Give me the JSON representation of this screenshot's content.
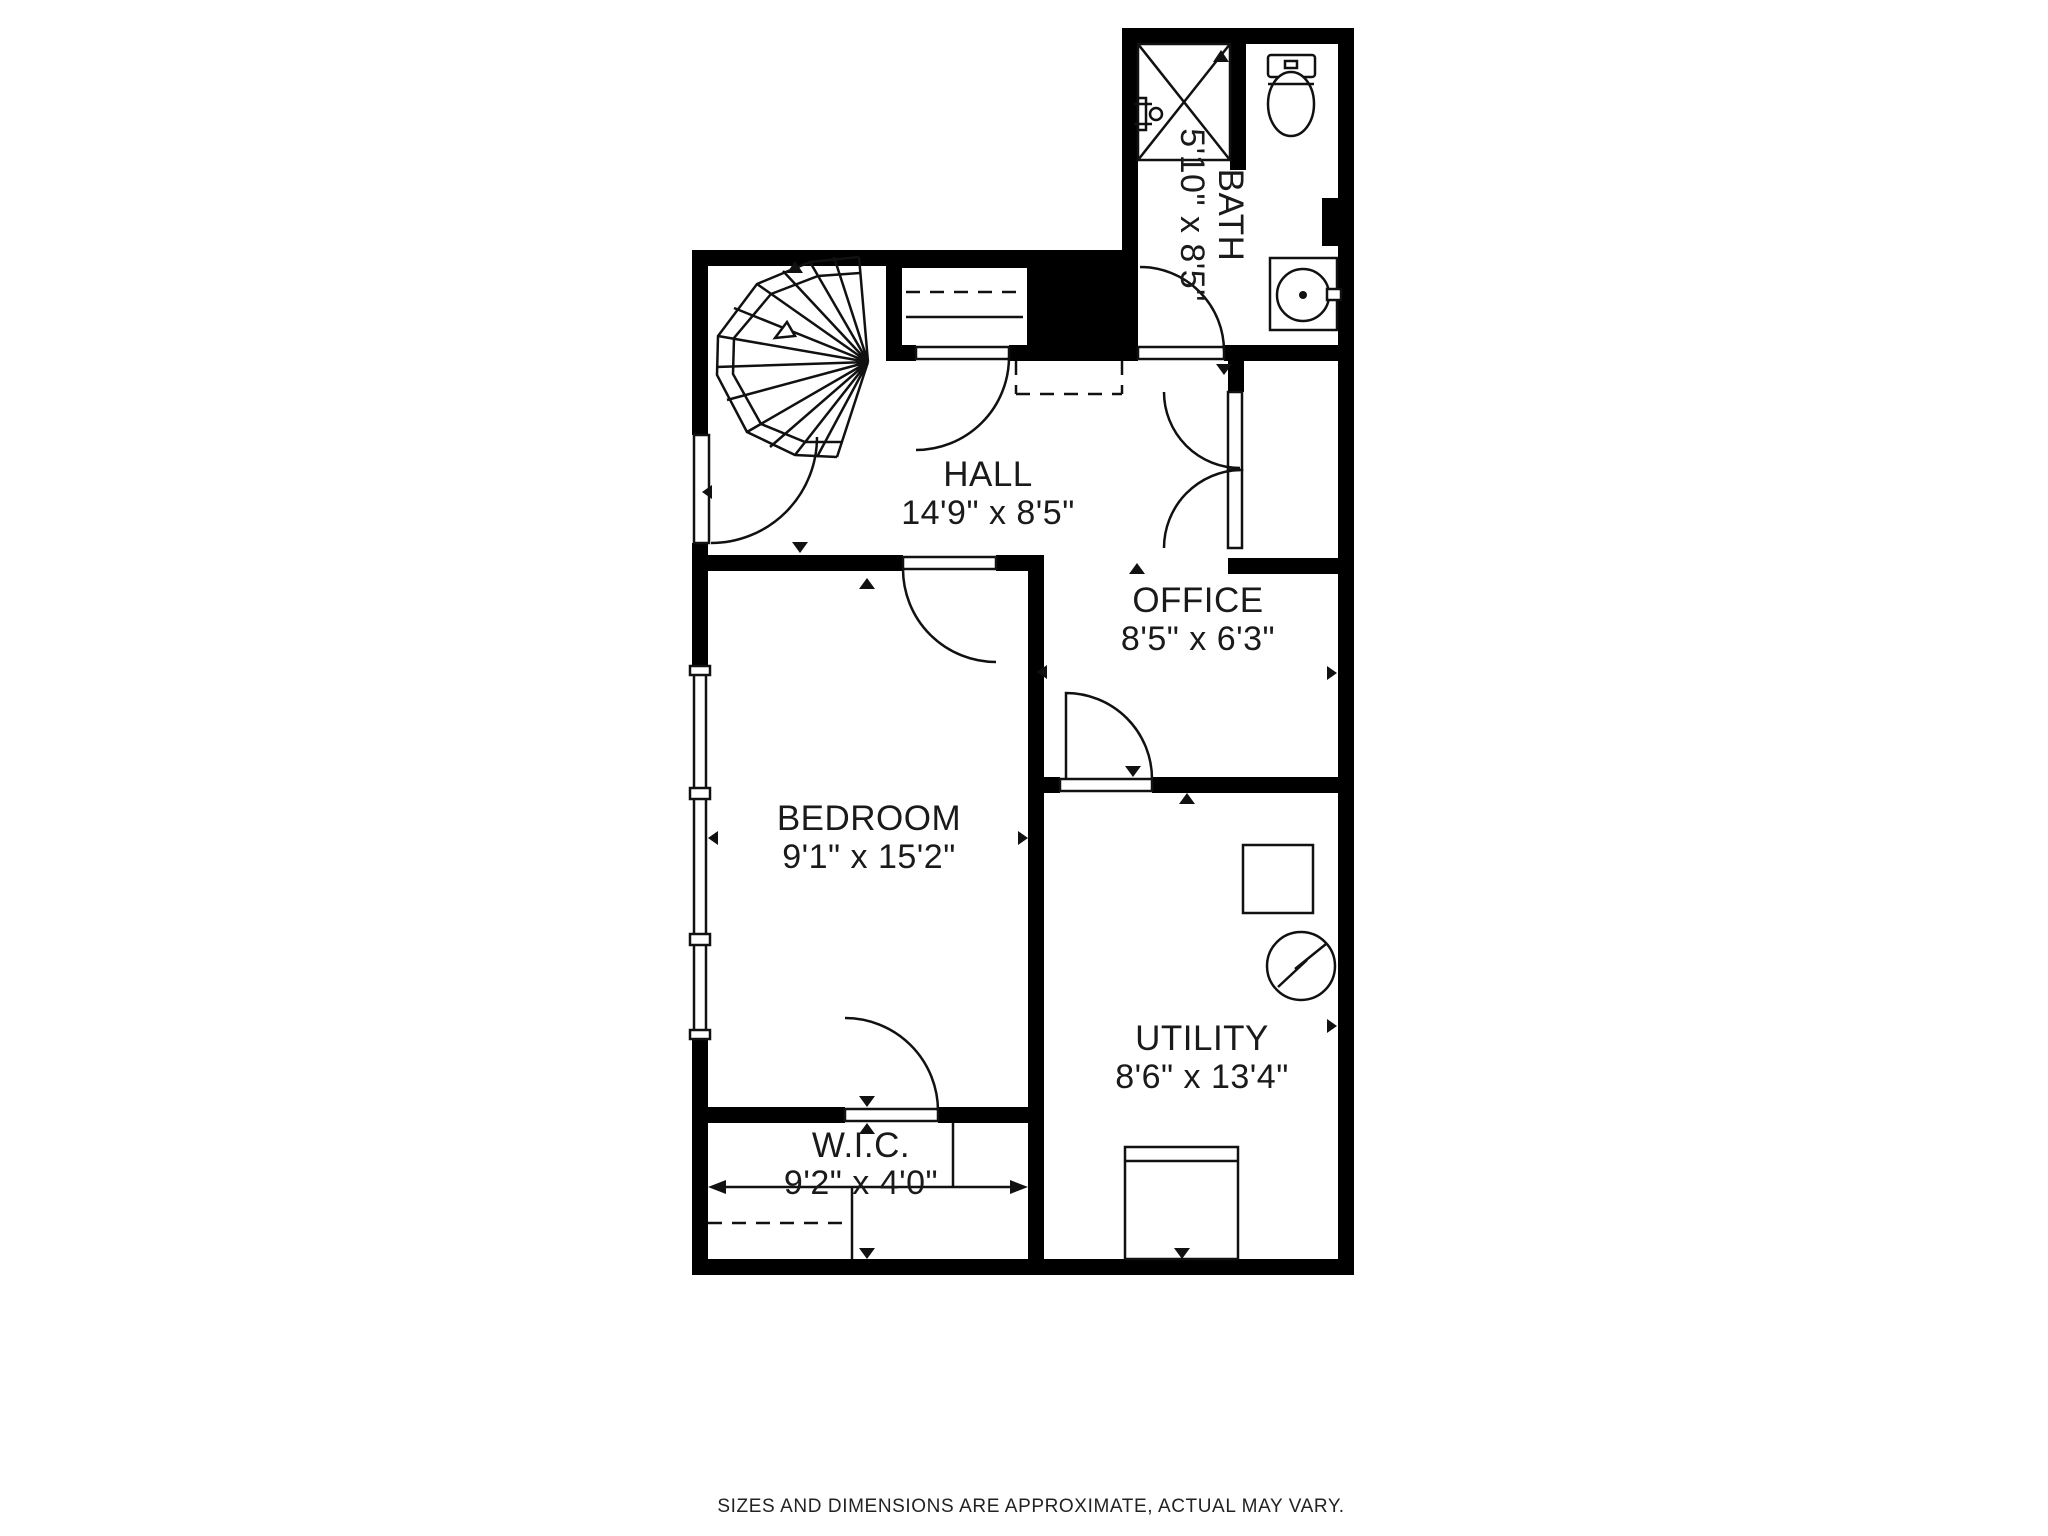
{
  "page": {
    "background": "#ffffff",
    "wall_color": "#000000",
    "line_color": "#111111",
    "text_color": "#1a1a1a"
  },
  "rooms": {
    "hall": {
      "name": "HALL",
      "dimensions": "14'9\" x 8'5\""
    },
    "bath": {
      "name": "BATH",
      "dimensions": "5'10\" x 8'5\""
    },
    "office": {
      "name": "OFFICE",
      "dimensions": "8'5\" x 6'3\""
    },
    "bedroom": {
      "name": "BEDROOM",
      "dimensions": "9'1\" x 15'2\""
    },
    "utility": {
      "name": "UTILITY",
      "dimensions": "8'6\" x 13'4\""
    },
    "wic": {
      "name": "W.I.C.",
      "dimensions": "9'2\" x 4'0\""
    }
  },
  "fixtures": [
    "spiral-staircase",
    "shower",
    "toilet",
    "bathroom-sink-vanity",
    "hall-closet",
    "office-double-door-closet",
    "utility-appliance-square",
    "electric-heater-circle",
    "washer",
    "bedroom-window",
    "closet-rod"
  ],
  "footer": {
    "disclaimer": "SIZES AND DIMENSIONS ARE APPROXIMATE, ACTUAL MAY VARY."
  }
}
